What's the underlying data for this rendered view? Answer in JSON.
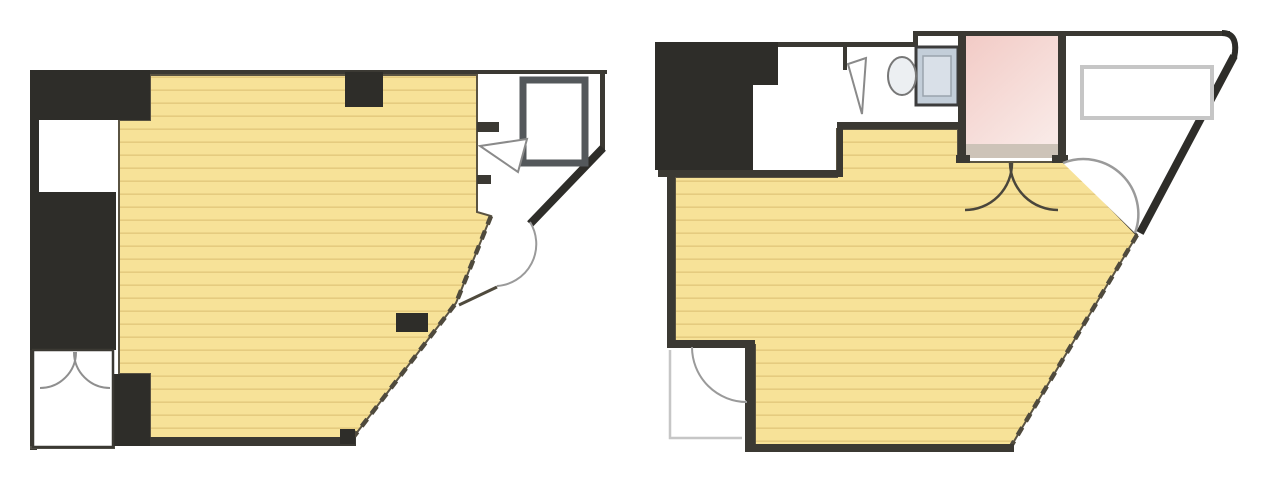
{
  "page": {
    "kind": "real-estate floor plan sheet",
    "description": "Two architectural floor plans shown side by side, no text labels",
    "background": "#ffffff"
  },
  "colors": {
    "room_fill": "#f7e298",
    "room_stripe": "#e5cb7f",
    "wall_dark": "#3b3933",
    "block_black": "#2e2d29",
    "gray_room_border": "#54585b",
    "pink_room_top": "#f2cbc6",
    "pink_room_bottom": "#f9e9e6",
    "pink_room_base_strip": "#cdc3b8",
    "fixture_tank_blue": "#c3ced9",
    "fixture_bowl": "#eceff2",
    "door_arc_gray": "#9a9a9a",
    "exterior_line_gray": "#c6c6c6",
    "dashed_window_edge": "#4f4a3d"
  },
  "plans": [
    {
      "id": "left",
      "name": "floor-plan-left",
      "features": [
        "striped-main-room",
        "black-structure-blocks",
        "closet-with-double-doors",
        "small-gray-bordered-room",
        "diagonal-outer-wall",
        "dashed-window-edge",
        "door-swing-arcs",
        "wall-pillars"
      ]
    },
    {
      "id": "right",
      "name": "floor-plan-right",
      "features": [
        "striped-main-room",
        "black-structure-block",
        "wc-pink-room",
        "toilet-fixture-icon",
        "double-door-arcs",
        "counter-outline",
        "diagonal-outer-wall",
        "dashed-window-edge",
        "balcony-outline",
        "entry-notch-with-door"
      ]
    }
  ]
}
